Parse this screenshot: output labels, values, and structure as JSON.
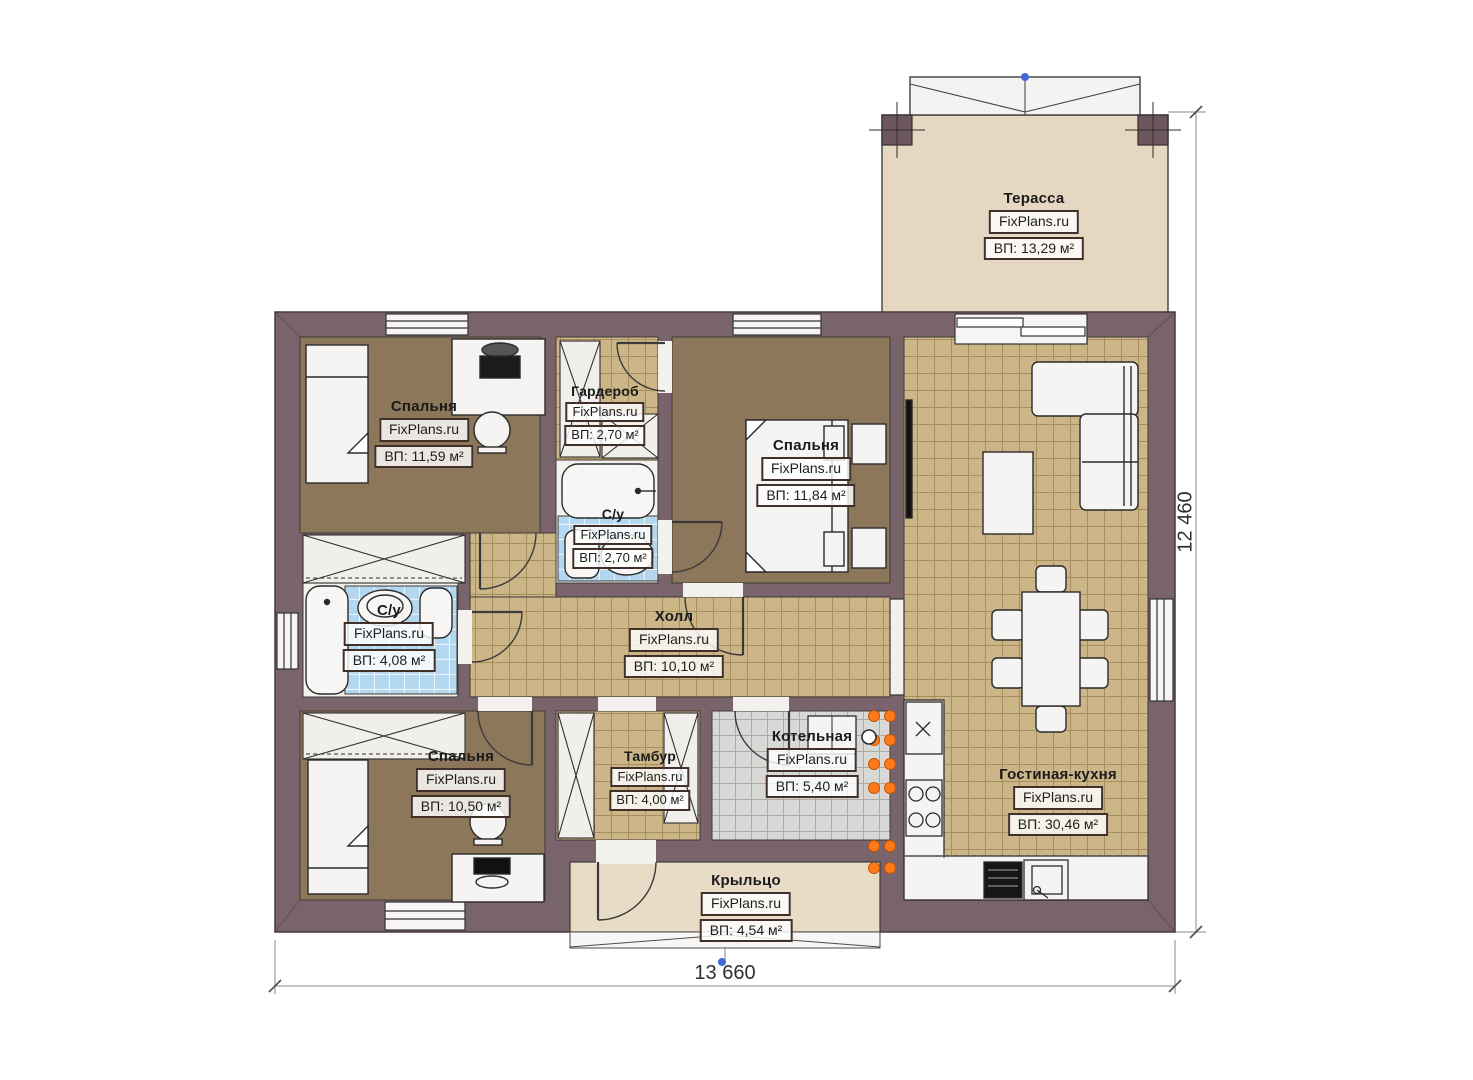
{
  "site_brand": "FixPlans.ru",
  "dimensions": {
    "width_mm": "13 660",
    "height_mm": "12 460"
  },
  "rooms": [
    {
      "id": "terrace",
      "name": "Терасса",
      "brand": "FixPlans.ru",
      "area": "ВП: 13,29 м²"
    },
    {
      "id": "bedroom-tl",
      "name": "Спальня",
      "brand": "FixPlans.ru",
      "area": "ВП: 11,59 м²"
    },
    {
      "id": "wardrobe",
      "name": "Гардероб",
      "brand": "FixPlans.ru",
      "area": "ВП: 2,70 м²"
    },
    {
      "id": "bedroom-tr",
      "name": "Спальня",
      "brand": "FixPlans.ru",
      "area": "ВП: 11,84 м²"
    },
    {
      "id": "bath-small",
      "name": "С/у",
      "brand": "FixPlans.ru",
      "area": "ВП: 2,70 м²"
    },
    {
      "id": "bath-left",
      "name": "С/у",
      "brand": "FixPlans.ru",
      "area": "ВП: 4,08 м²"
    },
    {
      "id": "hall",
      "name": "Холл",
      "brand": "FixPlans.ru",
      "area": "ВП: 10,10 м²"
    },
    {
      "id": "bedroom-bl",
      "name": "Спальня",
      "brand": "FixPlans.ru",
      "area": "ВП: 10,50 м²"
    },
    {
      "id": "tambour",
      "name": "Тамбур",
      "brand": "FixPlans.ru",
      "area": "ВП: 4,00 м²"
    },
    {
      "id": "boiler",
      "name": "Котельная",
      "brand": "FixPlans.ru",
      "area": "ВП: 5,40 м²"
    },
    {
      "id": "living-kitchen",
      "name": "Гостиная-кухня",
      "brand": "FixPlans.ru",
      "area": "ВП: 30,46 м²"
    },
    {
      "id": "porch",
      "name": "Крыльцо",
      "brand": "FixPlans.ru",
      "area": "ВП: 4,54 м²"
    }
  ],
  "colors": {
    "wall": "#7a646c",
    "bedroom_floor": "#8d775a",
    "tile_floor": "#ccb687",
    "bath_tile": "#b3d7ee",
    "boiler_tile": "#d8d8d6",
    "terrace_floor": "#e5d7c1",
    "accent_orange": "#ff7a1a",
    "dimension_blue": "#3f6ad8"
  }
}
